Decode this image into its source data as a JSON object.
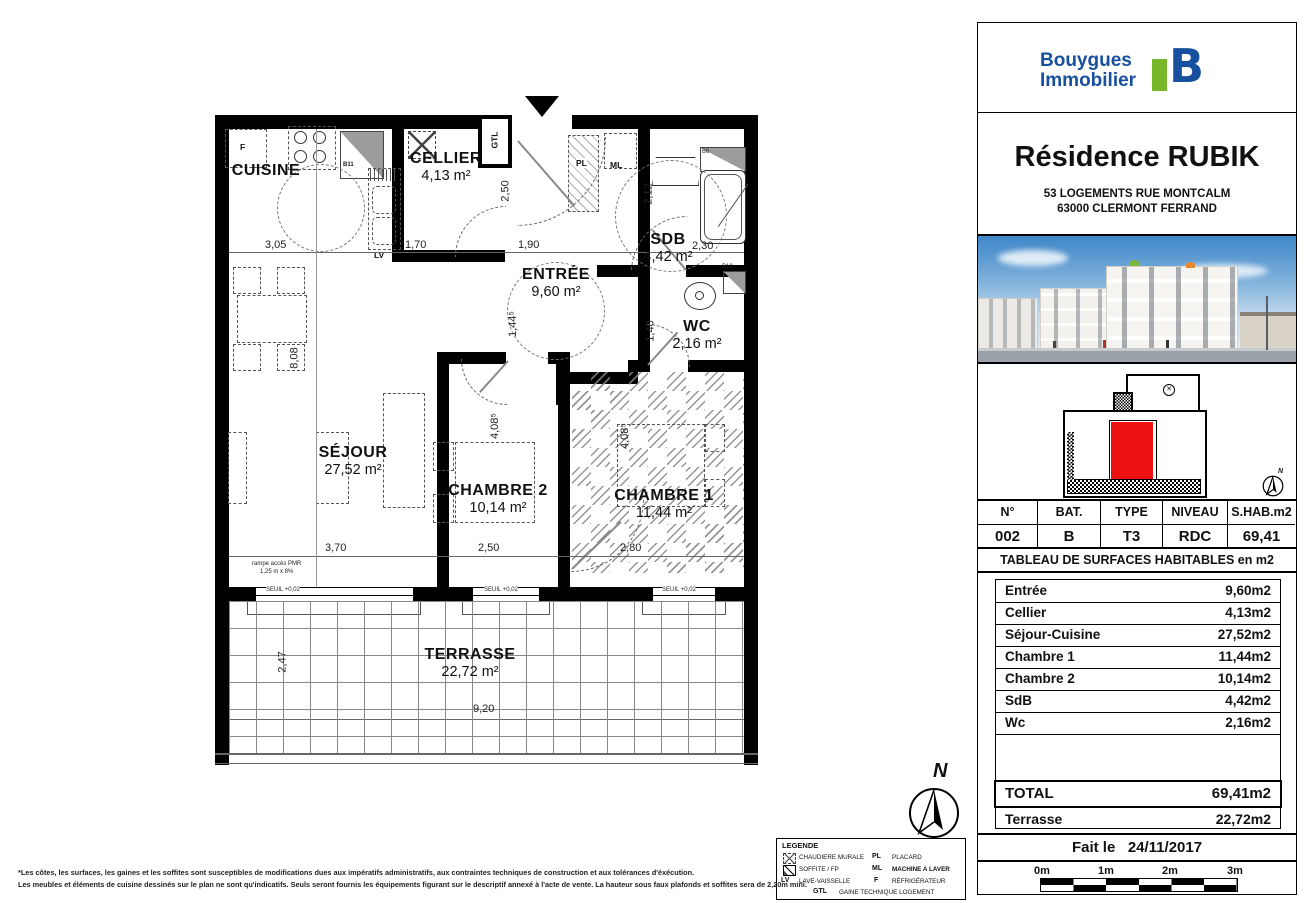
{
  "branding": {
    "name1": "Bouygues",
    "name2": "Immobilier"
  },
  "header": {
    "title": "Résidence RUBIK",
    "address1": "53 LOGEMENTS RUE MONTCALM",
    "address2": "63000 CLERMONT FERRAND"
  },
  "unit_info": {
    "headers": [
      "N°",
      "BAT.",
      "TYPE",
      "NIVEAU",
      "S.HAB.m2"
    ],
    "values": [
      "002",
      "B",
      "T3",
      "RDC",
      "69,41"
    ]
  },
  "surface_table": {
    "title": "TABLEAU DE SURFACES HABITABLES en m2",
    "rows": [
      {
        "label": "Entrée",
        "value": "9,60m2"
      },
      {
        "label": "Cellier",
        "value": "4,13m2"
      },
      {
        "label": "Séjour-Cuisine",
        "value": "27,52m2"
      },
      {
        "label": "Chambre 1",
        "value": "11,44m2"
      },
      {
        "label": "Chambre 2",
        "value": "10,14m2"
      },
      {
        "label": "SdB",
        "value": "4,42m2"
      },
      {
        "label": "Wc",
        "value": "2,16m2"
      }
    ],
    "total": {
      "label": "TOTAL",
      "value": "69,41m2"
    },
    "terrasse": {
      "label": "Terrasse",
      "value": "22,72m2"
    }
  },
  "date": {
    "label": "Fait le",
    "value": "24/11/2017"
  },
  "scale_bar": {
    "labels": [
      "0m",
      "1m",
      "2m",
      "3m"
    ]
  },
  "plan": {
    "rooms": [
      {
        "name": "CUISINE",
        "area": ""
      },
      {
        "name": "CELLIER",
        "area": "4,13 m²"
      },
      {
        "name": "ENTRÉE",
        "area": "9,60 m²"
      },
      {
        "name": "SDB",
        "area": "4,42 m²"
      },
      {
        "name": "WC",
        "area": "2,16 m²"
      },
      {
        "name": "SÉJOUR",
        "area": "27,52 m²"
      },
      {
        "name": "CHAMBRE 2",
        "area": "10,14 m²"
      },
      {
        "name": "CHAMBRE 1",
        "area": "11,44 m²"
      },
      {
        "name": "TERRASSE",
        "area": "22,72 m²"
      }
    ],
    "dims": {
      "d305": "3,05",
      "d170": "1,70",
      "d190": "1,90",
      "d230": "2,30",
      "d212": "2,12",
      "d250v": "2,50",
      "d1445": "1,44⁵",
      "d140": "1,40",
      "d808": "8,08",
      "d4085a": "4,08⁵",
      "d4085b": "4,08⁵",
      "d370": "3,70",
      "d250h": "2,50",
      "d280": "2,80",
      "d247": "2,47",
      "d920": "9,20"
    },
    "tags": {
      "f": "F",
      "b11": "B11",
      "gtl": "GTL",
      "pl": "PL",
      "ml": "ML",
      "b6": "B6",
      "b10": "B10",
      "lv": "LV"
    },
    "annotations": {
      "ramp1": "rampe accès PMR",
      "ramp2": "1,25 m x 8%",
      "seuil": "SEUIL +0,02",
      "north": "N"
    }
  },
  "legend": {
    "title": "LEGENDE",
    "items": [
      {
        "abbr": "",
        "label": "CHAUDIERE MURALE"
      },
      {
        "abbr": "",
        "label": "SOFFITE / FP"
      },
      {
        "abbr": "LV",
        "label": "LAVE-VAISSELLE"
      },
      {
        "abbr": "PL",
        "label": "PLACARD"
      },
      {
        "abbr": "ML",
        "label": "MACHINE A LAVER"
      },
      {
        "abbr": "F",
        "label": "RÉFRIGÉRATEUR"
      },
      {
        "abbr": "GTL",
        "label": "GAINE TECHNIQUE LOGEMENT"
      }
    ]
  },
  "footer": {
    "line1": "*Les côtes, les surfaces, les gaines et les soffites sont susceptibles de modifications dues aux impératifs administratifs, aux contraintes techniques de construction et aux tolérances d'éxécution.",
    "line2": "Les meubles et éléments de cuisine dessinés sur le plan ne sont qu'indicatifs. Seuls seront fournis les équipements figurant sur le descriptif annexé à l'acte de vente. La hauteur sous faux plafonds et soffites sera de 2,20m mini."
  },
  "colors": {
    "brand_blue": "#17509e",
    "brand_green": "#76b82a",
    "unit_red": "#ee1111",
    "hatch_gray": "#b7b7b7"
  }
}
